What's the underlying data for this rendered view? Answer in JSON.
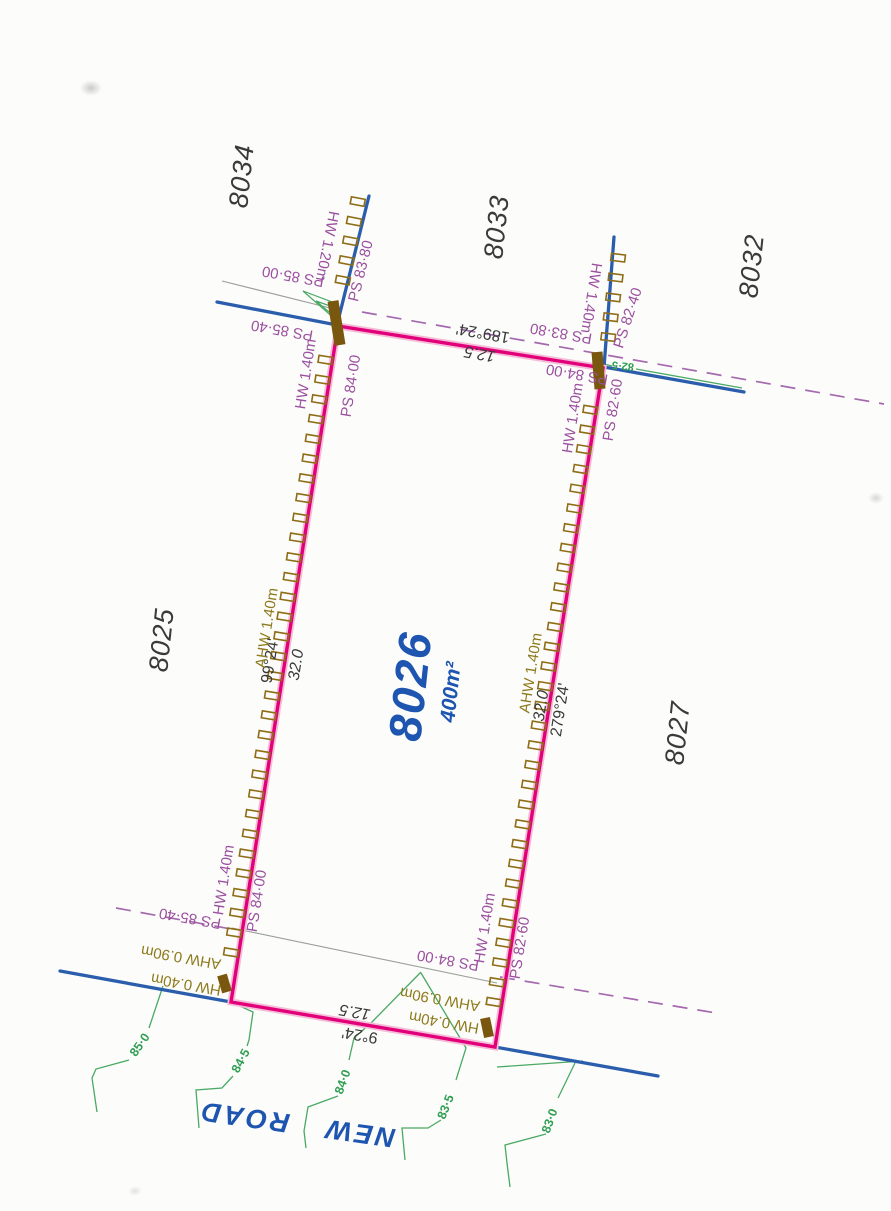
{
  "parcel": {
    "number": "8026",
    "area": "400m²"
  },
  "road": {
    "name": "NEW ROAD"
  },
  "adjacent_lots": {
    "north_west": "8034",
    "north": "8033",
    "north_east": "8032",
    "west": "8025",
    "east": "8027"
  },
  "dimensions": {
    "north": {
      "bearing": "189°24'",
      "distance": "12.5"
    },
    "south": {
      "bearing": "9°24'",
      "distance": "12.5"
    },
    "west": {
      "bearing": "99°24'",
      "distance": "32.0"
    },
    "east": {
      "bearing": "279°24'",
      "distance": "32.0"
    }
  },
  "retaining_walls": {
    "north_extension_west": "HW 1.20m",
    "north_extension_east": "HW 1.40m",
    "west_upper": "HW 1.40m",
    "west_middle": "AHW 1.40m",
    "west_lower": "HW 1.40m",
    "east_upper": "HW 1.40m",
    "east_middle": "AHW 1.40m",
    "east_lower": "HW 1.40m",
    "south_west_upper": "AHW 0.90m",
    "south_west_lower": "HW 0.40m",
    "south_east_upper": "AHW 0.90m",
    "south_east_lower": "HW 0.40m"
  },
  "surface_levels": {
    "nw_outer_upper": "PS 85·00",
    "nw_chain": "PS 83·80",
    "nw_outer": "PS 85·40",
    "west_upper_inner": "PS 84·00",
    "west_lower_inner": "PS 84·00",
    "sw_outer": "PS 85·40",
    "north_inner_east": "PS 84·00",
    "north_mid": "PS 83·80",
    "ne_chain": "PS 82·40",
    "east_upper_outer": "PS 82·60",
    "east_lower_outer": "PS 82·60",
    "south_inner_east": "PS 84·00"
  },
  "contour_labels": {
    "c85_0": "85·0",
    "c84_5": "84·5",
    "c84_0": "84·0",
    "c83_5": "83·5",
    "c83_0": "83·0",
    "c82_5": "82·5"
  },
  "colors": {
    "boundary_magenta": "#e2007a",
    "service_blue": "#2b5dad",
    "contour_green": "#4aa964",
    "wall_brown": "#8f6d16",
    "level_purple": "#9b4f9f",
    "wall_label_olive": "#8c7a1c",
    "parcel_blue": "#1d55b0",
    "easement_mauve": "#a469ae",
    "text_black": "#3a3a3a"
  }
}
